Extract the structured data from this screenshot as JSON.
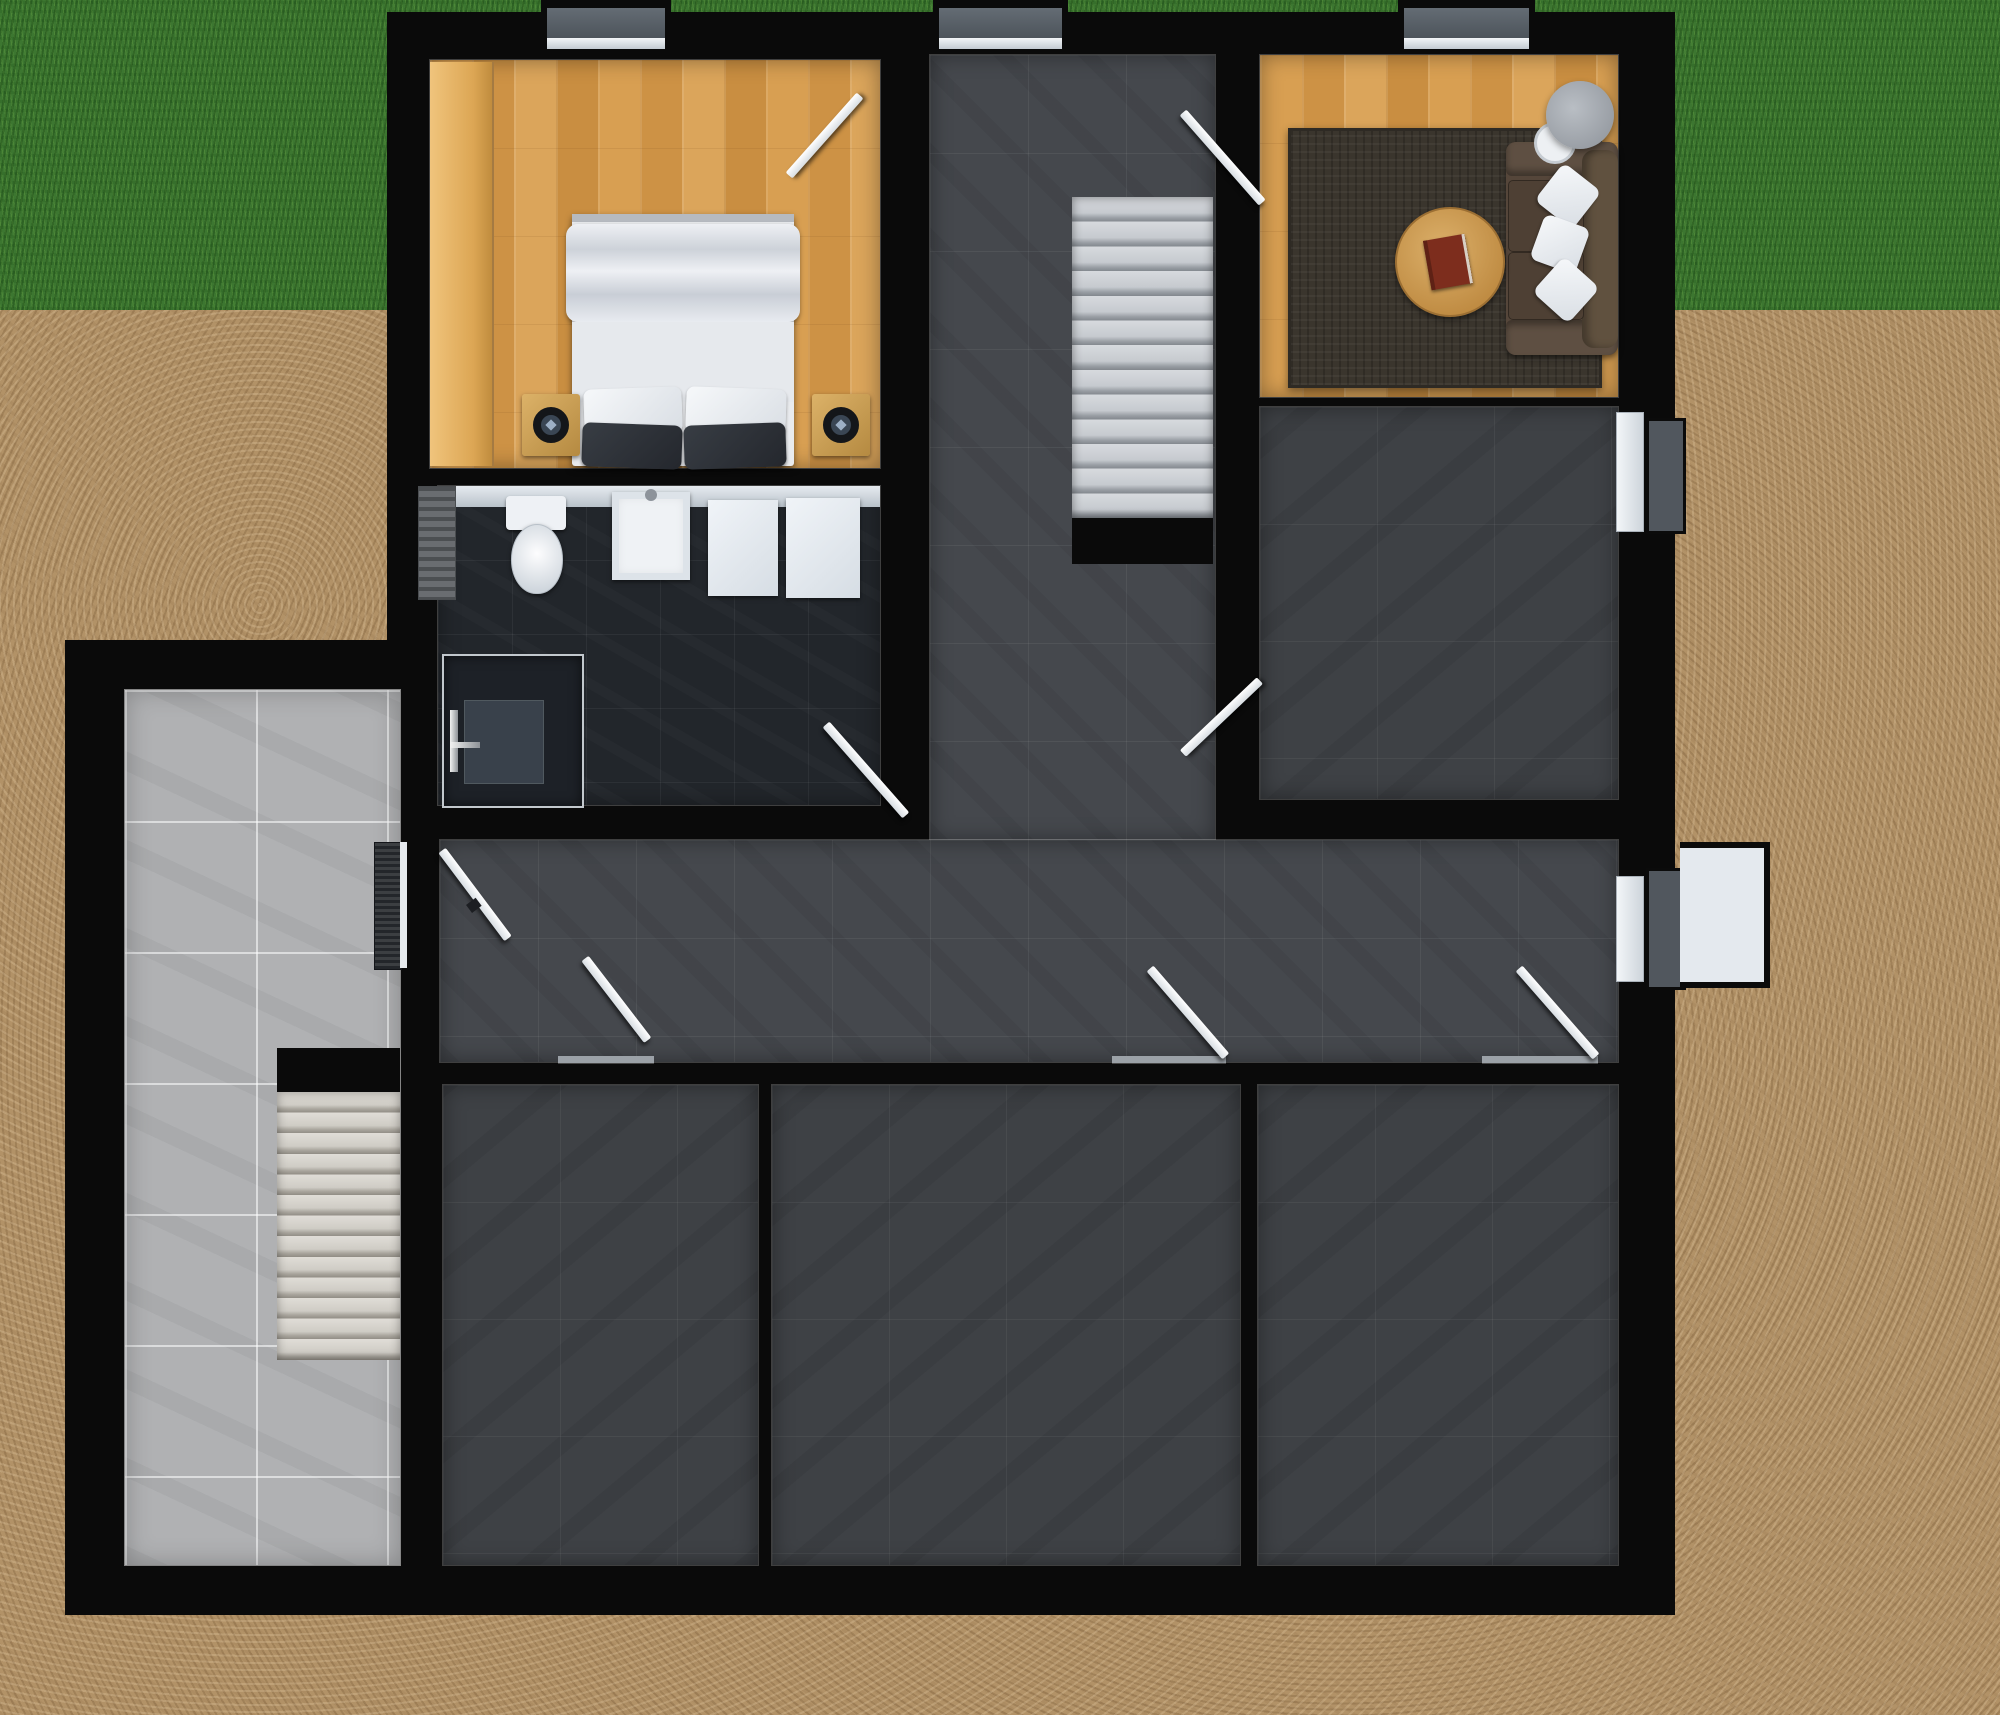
{
  "scene": {
    "title": "Rendered top-down basement floor plan",
    "view": "top-down",
    "style": "3d-architectural-render"
  },
  "colors": {
    "grass": "#3c7630",
    "soil": "#b29267",
    "wall": "#0a0a0a",
    "wood": "#d29649",
    "wood-light": "#e9bd74",
    "tile-mid": "#45484d",
    "tile-dark": "#3e4145",
    "tile-bath": "#22262b",
    "tile-terrace": "#b0b1b3",
    "stair-concrete": "#c6cacf",
    "stair-exterior": "#d6d3cd",
    "door-leaf": "#d7dde2",
    "sofa": "#55463a",
    "rug": "#3a352d",
    "table-wood": "#bf8b42",
    "lamp-shade": "#8d9299",
    "bed-linen": "#e9ebee",
    "pillow-dark": "#24272d",
    "counter": "#dfe5ea",
    "fixture-white": "#f0f3f6",
    "well": "#e4e9ee",
    "window-panel": "#51575e"
  },
  "rooms": [
    {
      "name": "bedroom",
      "floor": "wood-parquet"
    },
    {
      "name": "living-room",
      "floor": "wood-parquet"
    },
    {
      "name": "stair-hall",
      "floor": "gray-tile"
    },
    {
      "name": "bathroom",
      "floor": "black-tile"
    },
    {
      "name": "utility-room",
      "floor": "gray-tile"
    },
    {
      "name": "corridor",
      "floor": "gray-tile"
    },
    {
      "name": "storage-room-left",
      "floor": "gray-tile"
    },
    {
      "name": "storage-room-middle",
      "floor": "gray-tile"
    },
    {
      "name": "storage-room-right",
      "floor": "gray-tile"
    },
    {
      "name": "sunken-terrace",
      "floor": "light-tile"
    }
  ],
  "furniture": {
    "bed": "double-bed",
    "speakers": "loudspeaker-pair",
    "wardrobe": "wardrobe-panel",
    "sofa": "three-seat-sofa",
    "sofa_pillows": "white-pillows-x3",
    "rug": "area-rug",
    "coffee_table": "round-coffee-table",
    "book": "book",
    "lamp": "floor-lamp",
    "toilet": "toilet",
    "sink": "washbasin",
    "shower": "shower-cabin",
    "mats": "bath-mats-x2",
    "radiator": "radiator",
    "counter": "bathroom-counter",
    "grate": "entry-floor-grate"
  },
  "stairs": {
    "interior": {
      "steps": 13,
      "material": "concrete"
    },
    "exterior": {
      "steps": 13,
      "material": "concrete"
    }
  },
  "doors": [
    "bedroom-door",
    "living-room-door",
    "utility-room-door",
    "bathroom-door",
    "terrace-entry-door",
    "storage-left-door",
    "storage-middle-door",
    "storage-right-door"
  ],
  "windows": [
    "bedroom-window-well",
    "stair-hall-window-well",
    "living-room-window-well",
    "utility-room-window-well",
    "corridor-window-well"
  ]
}
